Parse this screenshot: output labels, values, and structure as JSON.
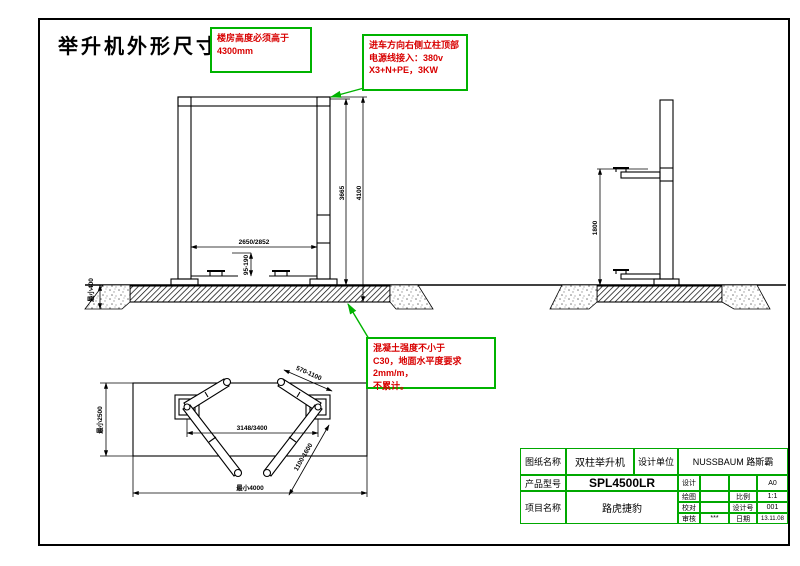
{
  "title": "举升机外形尺寸图",
  "notes": {
    "building_height": "楼房高度必须高于\n4300mm",
    "power_supply": "进车方向右侧立柱顶部\n电源线接入：380v\nX3+N+PE，3KW",
    "concrete": "混凝土强度不小于\nC30，地面水平度要求2mm/m，\n不累计。"
  },
  "dims": {
    "front_width": "2650/2852",
    "front_pad_height": "95-190",
    "front_height_inner": "3665",
    "front_height_total": "4100",
    "foundation_depth": "最小400",
    "side_lift_height": "1800",
    "plan_bay_depth": "最小2500",
    "plan_anchor_span": "3148/3400",
    "plan_bay_width": "最小4000",
    "plan_arm_short": "570-1100",
    "plan_arm_long": "1100-1600"
  },
  "title_block": {
    "drawing_name_label": "图纸名称",
    "drawing_name": "双柱举升机",
    "design_unit_label": "设计单位",
    "design_unit": "NUSSBAUM 路斯霸",
    "product_model_label": "产品型号",
    "product_model": "SPL4500LR",
    "project_name_label": "项目名称",
    "project_name": "路虎捷豹",
    "design_label": "设计",
    "paper_size": "A0",
    "draft_label": "绘图",
    "scale_label": "比例",
    "scale": "1:1",
    "check_label": "校对",
    "design_no_label": "设计号",
    "design_no": "001",
    "audit_label": "审核",
    "audit_sign": "***",
    "date_label": "日期",
    "date": "13.11.08"
  },
  "colors": {
    "annotation_green": "#00b300",
    "annotation_red": "#d80000",
    "line_black": "#000000"
  }
}
